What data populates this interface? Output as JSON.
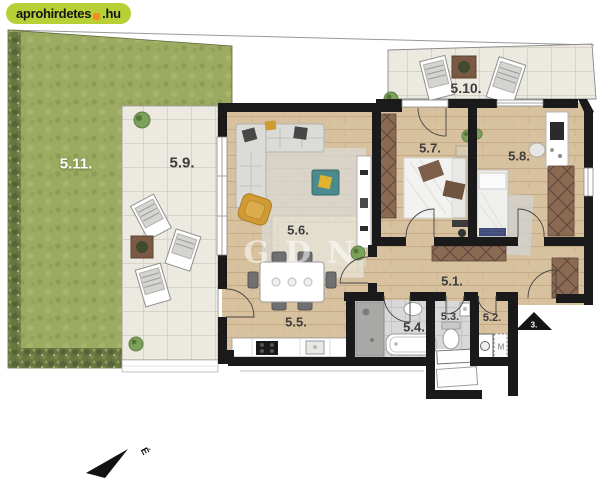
{
  "logo": {
    "brand": "aprohirdetes",
    "tld": ".hu"
  },
  "watermark": {
    "text": "GDN"
  },
  "markers": {
    "entrance": "3.",
    "north": "É",
    "washing_machine": "M"
  },
  "rooms": [
    {
      "label": "5.1."
    },
    {
      "label": "5.2."
    },
    {
      "label": "5.3."
    },
    {
      "label": "5.4."
    },
    {
      "label": "5.5."
    },
    {
      "label": "5.6."
    },
    {
      "label": "5.7."
    },
    {
      "label": "5.8."
    },
    {
      "label": "5.9."
    },
    {
      "label": "5.10."
    },
    {
      "label": "5.11."
    }
  ],
  "colors": {
    "lawn": "#9cab61",
    "hedge": "#69763f",
    "terrace": "#ece9e0",
    "wood": "#d8c19e",
    "bath": "#d8d8d8",
    "wall": "#1a1a1a",
    "wardrobe": "#8a6a52",
    "wardrobe_line": "#5f463a",
    "sofa": "#dbdbd8",
    "rug": "#d9d9d4",
    "teal": "#4b8b8d",
    "mustard": "#d09b33",
    "logo_bg": "#b8cf36",
    "logo_accent": "#f68b1f",
    "label_dark": "#3c3c3c",
    "label_light": "#ffffff"
  }
}
